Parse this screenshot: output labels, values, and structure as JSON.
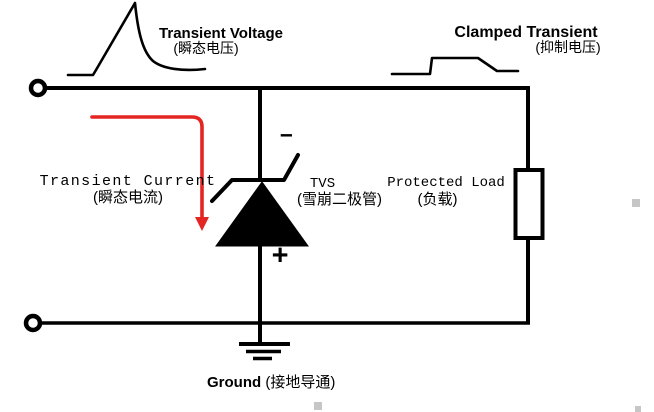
{
  "canvas": {
    "width": 654,
    "height": 412,
    "background": "#ffffff"
  },
  "colors": {
    "line": "#000000",
    "arrow_red": "#e42522",
    "artifact_gray": "#c6c6c6"
  },
  "labels": {
    "transient_voltage": {
      "en": "Transient Voltage",
      "zh": "(瞬态电压)"
    },
    "clamped_transient": {
      "en": "Clamped Transient",
      "zh": "(抑制电压)"
    },
    "transient_current": {
      "en": "Transient Current",
      "zh": "(瞬态电流)"
    },
    "tvs": {
      "en": "TVS",
      "zh": "(雪崩二极管)"
    },
    "protected_load": {
      "en": "Protected Load",
      "zh": "(负载)"
    },
    "ground": {
      "en": "Ground",
      "zh": "(接地导通)"
    },
    "polarity": {
      "minus": "−",
      "plus": "+"
    }
  },
  "icons": {
    "spike_waveform": "transient voltage spike curve",
    "clamped_waveform": "clamped trapezoid pulse curve",
    "current_arrow": "red right-then-down current arrow",
    "tvs_diode": "unidirectional TVS zener diode symbol",
    "load_resistor": "rectangular load resistor",
    "ground_symbol": "three-bar earth ground",
    "input_terminals": "open circle input terminals"
  }
}
